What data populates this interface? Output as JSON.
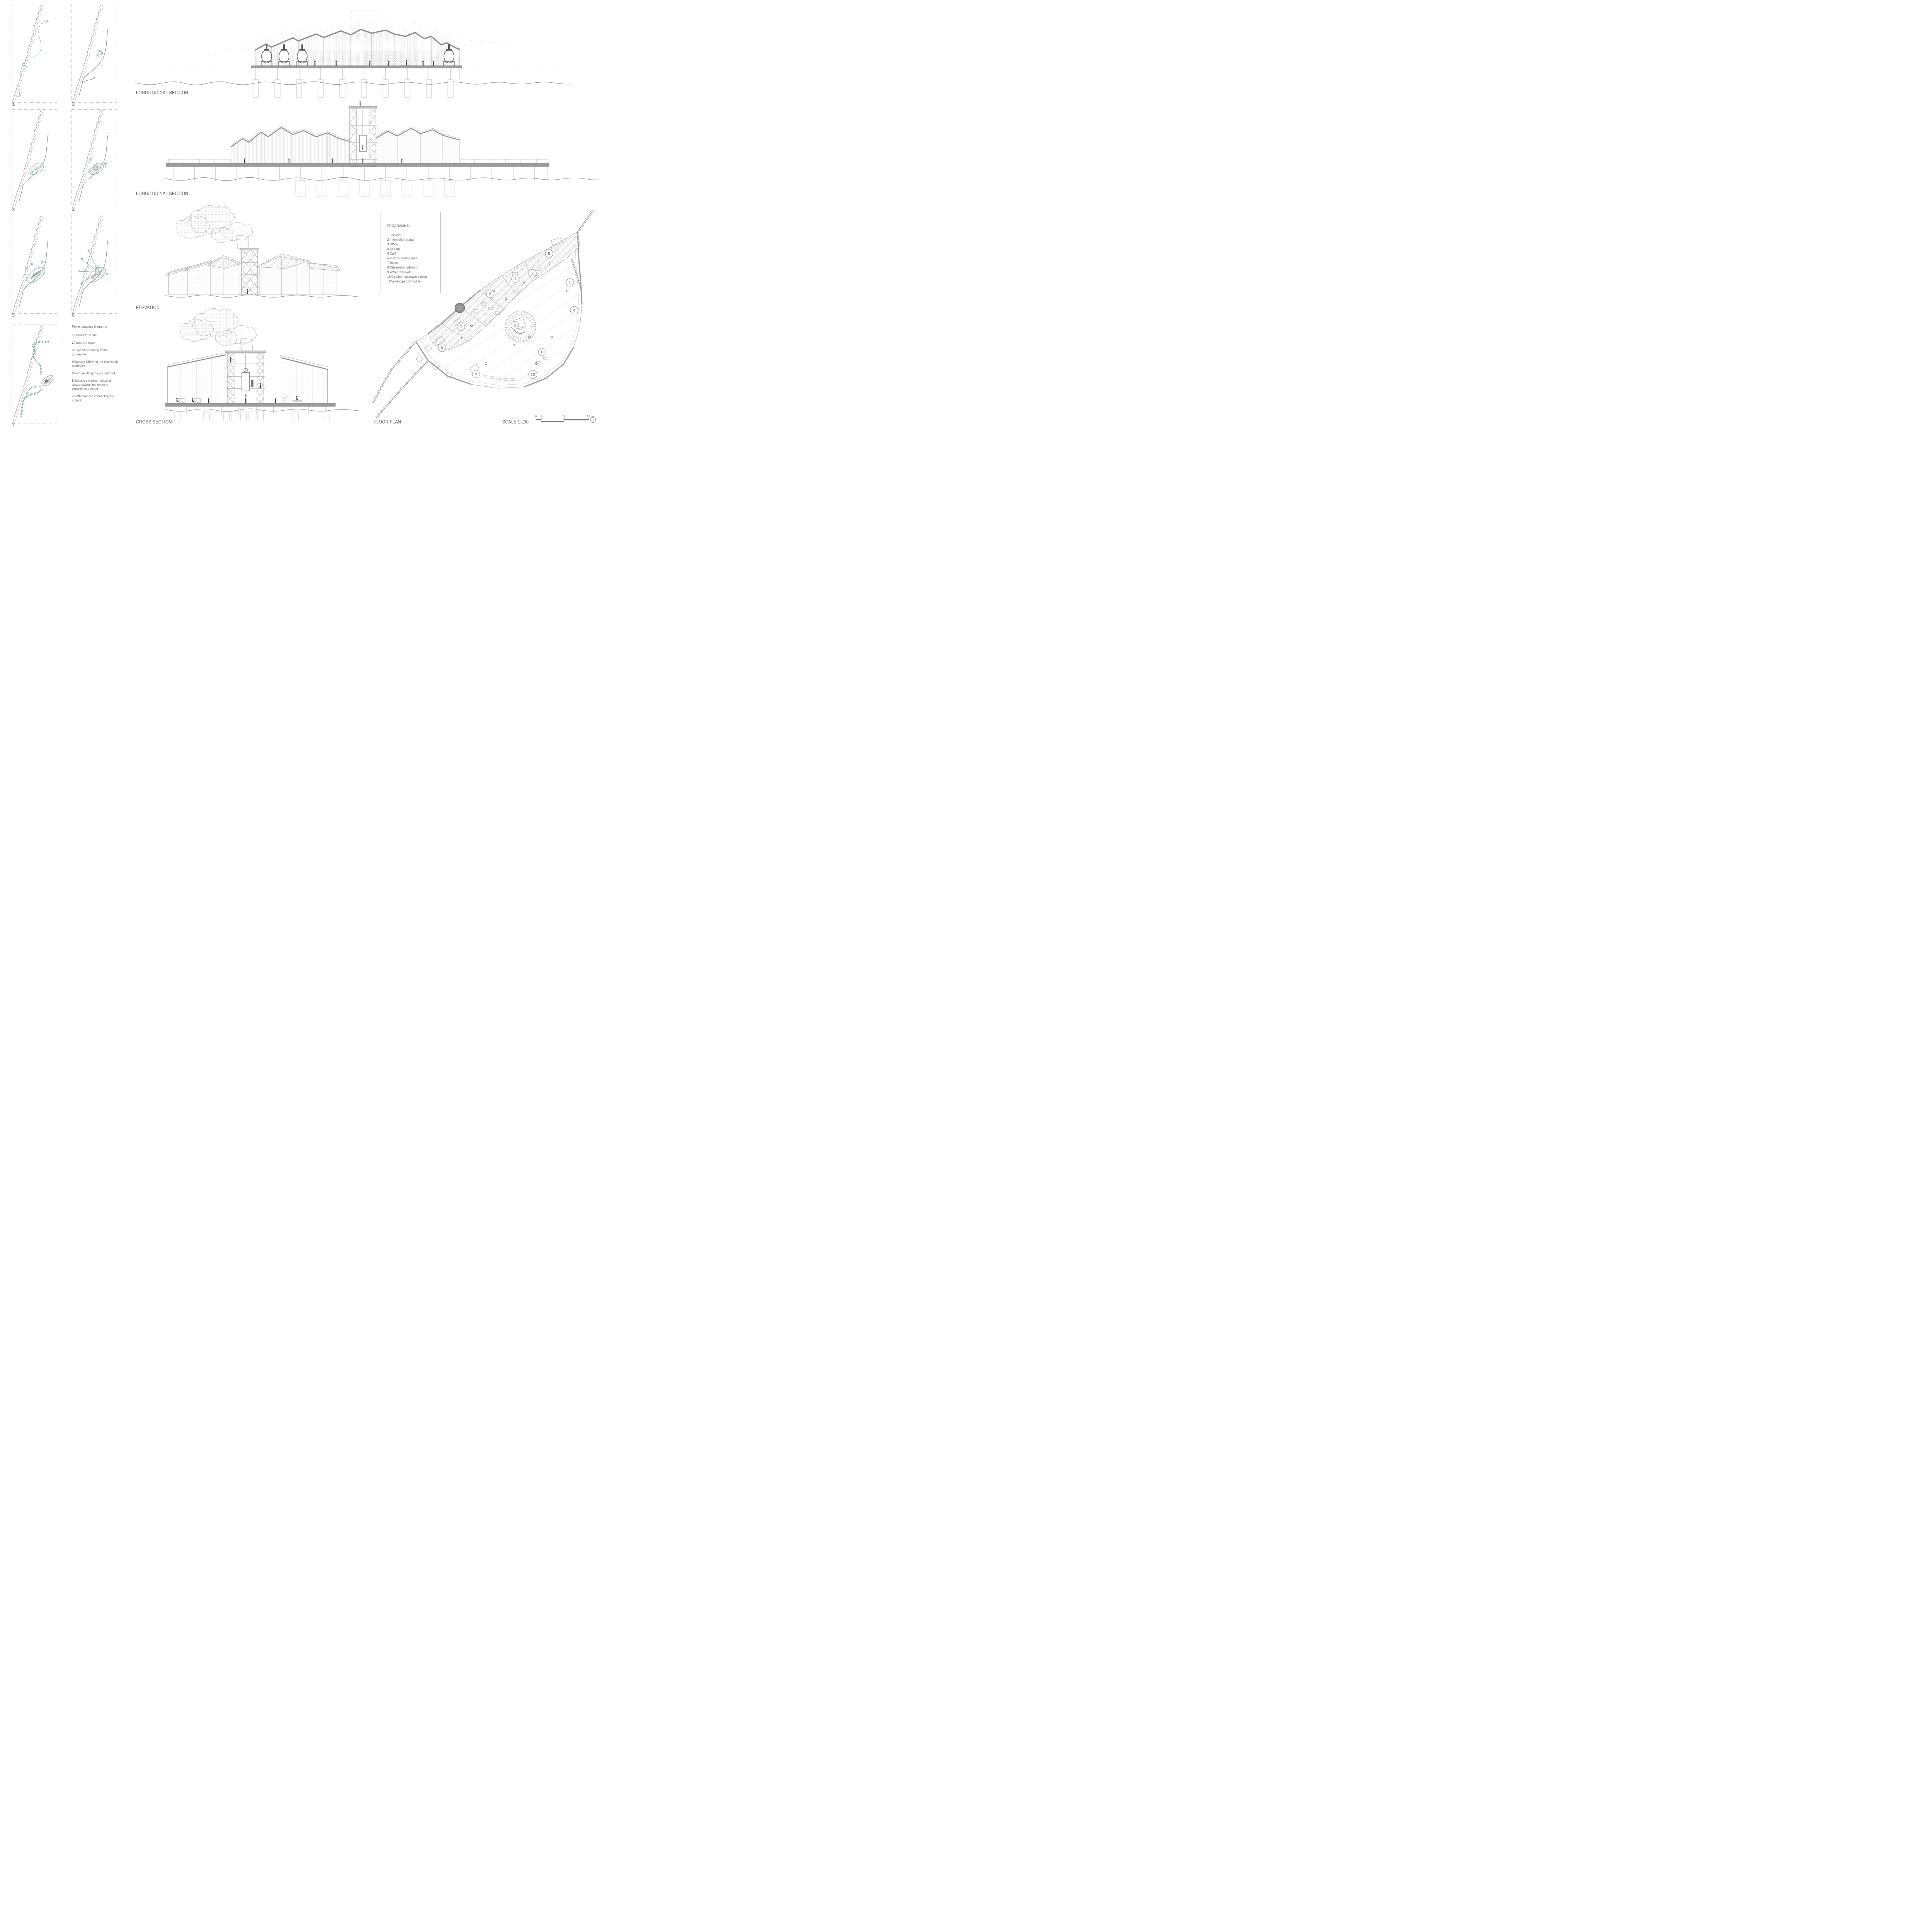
{
  "panels": {
    "labels": [
      "1",
      "2",
      "3",
      "4",
      "5",
      "6",
      "7"
    ]
  },
  "process_notes": {
    "title": "Project process diagrams:",
    "items": [
      {
        "num": "1",
        "text": "Connect the site"
      },
      {
        "num": "2",
        "text": "Place the tower"
      },
      {
        "num": "3",
        "text": "Expand according to the prgramme"
      },
      {
        "num": "4",
        "text": "Extrude following the bioclimatic strategies"
      },
      {
        "num": "5",
        "text": "Fold resulting the pitched roof"
      },
      {
        "num": "6",
        "text": "Extrude the tower focusing views towards the tectonic continental division"
      },
      {
        "num": "7",
        "text": "Path modules connecting the project"
      }
    ]
  },
  "sections": {
    "long_section_top": "LONGITUDINAL SECTION",
    "long_section_mid": "LONGITUDINAL SECTION",
    "elevation": "ELEVATION",
    "cross_section": "CROSS SECTION",
    "floor_plan": "FLOOR PLAN"
  },
  "programme": {
    "title": "PROGRAMME:",
    "items": [
      "1 Lockers",
      "2 Information stand",
      "3 Office",
      "4 Storage",
      "5 Café",
      "6 Visitors waiting area",
      "7 Toilets",
      "8 Observation platform",
      "9 Water reservoit",
      "10 Geothermal power station",
      "11Walking patch module"
    ]
  },
  "floor_plan": {
    "markers": [
      {
        "label": "9"
      },
      {
        "label": "2"
      },
      {
        "label": "3"
      },
      {
        "label": "1"
      },
      {
        "label": "5"
      },
      {
        "label": "4"
      },
      {
        "label": "7"
      },
      {
        "label": "8"
      },
      {
        "label": "9"
      },
      {
        "label": "6"
      },
      {
        "label": "9"
      },
      {
        "label": "10"
      }
    ]
  },
  "scale": {
    "label": "SCALE 1:200",
    "ticks": [
      "0",
      "1",
      "5",
      "10"
    ]
  },
  "colors": {
    "accent_teal": "#7aa5a0",
    "line_gray": "#8a8a8a",
    "text_gray": "#595959"
  }
}
